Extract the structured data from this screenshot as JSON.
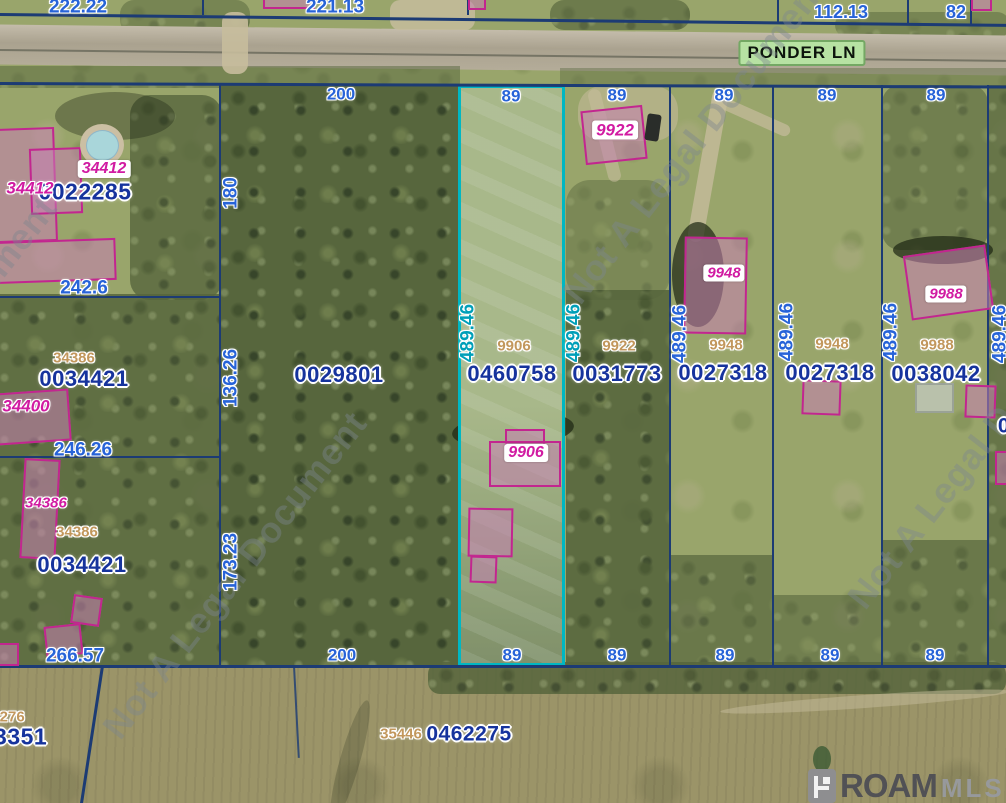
{
  "map": {
    "road_sign": "PONDER LN",
    "watermark_text": "Not A Legal Document",
    "watermarks": [
      {
        "x": 695,
        "y": 140
      },
      {
        "x": -75,
        "y": 360
      },
      {
        "x": 235,
        "y": 575
      },
      {
        "x": 980,
        "y": 445
      }
    ],
    "logo": {
      "name": "ROAM",
      "suffix": "MLS"
    },
    "highlight_color": "#00b7c3",
    "parcel_line_color": "#1c3b74",
    "subject_parcel": {
      "id": "0460758",
      "address": "9906",
      "frontage": "89",
      "depth": "489.46"
    }
  },
  "labels": [
    {
      "n": "dim-222-22",
      "t": "222.22",
      "x": 78,
      "y": 7,
      "c": "dim",
      "fs": 19
    },
    {
      "n": "dim-221-13",
      "t": "221.13",
      "x": 335,
      "y": 7,
      "c": "dim",
      "fs": 19
    },
    {
      "n": "dim-112-13",
      "t": "112.13",
      "x": 841,
      "y": 12,
      "c": "dim",
      "fs": 18
    },
    {
      "n": "dim-82",
      "t": "82",
      "x": 956,
      "y": 12,
      "c": "dim",
      "fs": 18
    },
    {
      "n": "dim-242-6",
      "t": "242.6",
      "x": 84,
      "y": 288,
      "c": "dim",
      "fs": 19
    },
    {
      "n": "dim-200-top",
      "t": "200",
      "x": 341,
      "y": 94,
      "c": "dim",
      "fs": 17
    },
    {
      "n": "dim-180",
      "t": "180",
      "x": 231,
      "y": 193,
      "c": "dim",
      "fs": 19,
      "r": -90
    },
    {
      "n": "dim-136-26",
      "t": "136.26",
      "x": 231,
      "y": 378,
      "c": "dim",
      "fs": 19,
      "r": -90
    },
    {
      "n": "dim-246-26",
      "t": "246.26",
      "x": 83,
      "y": 450,
      "c": "dim",
      "fs": 19
    },
    {
      "n": "dim-173-23",
      "t": "173.23",
      "x": 231,
      "y": 562,
      "c": "dim",
      "fs": 19,
      "r": -90
    },
    {
      "n": "dim-266-57",
      "t": "266.57",
      "x": 75,
      "y": 656,
      "c": "dim",
      "fs": 19
    },
    {
      "n": "dim-200-bottom",
      "t": "200",
      "x": 342,
      "y": 655,
      "c": "dim",
      "fs": 17
    },
    {
      "n": "dim-89-top-1",
      "t": "89",
      "x": 511,
      "y": 96,
      "c": "dim",
      "fs": 17
    },
    {
      "n": "dim-89-top-2",
      "t": "89",
      "x": 617,
      "y": 95,
      "c": "dim",
      "fs": 17
    },
    {
      "n": "dim-89-top-3",
      "t": "89",
      "x": 724,
      "y": 95,
      "c": "dim",
      "fs": 17
    },
    {
      "n": "dim-89-top-4",
      "t": "89",
      "x": 827,
      "y": 95,
      "c": "dim",
      "fs": 17
    },
    {
      "n": "dim-89-top-5",
      "t": "89",
      "x": 936,
      "y": 95,
      "c": "dim",
      "fs": 17
    },
    {
      "n": "dim-89-bot-1",
      "t": "89",
      "x": 512,
      "y": 655,
      "c": "dim",
      "fs": 17
    },
    {
      "n": "dim-89-bot-2",
      "t": "89",
      "x": 617,
      "y": 655,
      "c": "dim",
      "fs": 17
    },
    {
      "n": "dim-89-bot-3",
      "t": "89",
      "x": 725,
      "y": 655,
      "c": "dim",
      "fs": 17
    },
    {
      "n": "dim-89-bot-4",
      "t": "89",
      "x": 830,
      "y": 655,
      "c": "dim",
      "fs": 17
    },
    {
      "n": "dim-89-bot-5",
      "t": "89",
      "x": 935,
      "y": 655,
      "c": "dim",
      "fs": 17
    },
    {
      "n": "dim-489-46-1",
      "t": "489.46",
      "x": 468,
      "y": 333,
      "c": "dimTeal",
      "fs": 19,
      "r": -90
    },
    {
      "n": "dim-489-46-2",
      "t": "489.46",
      "x": 574,
      "y": 333,
      "c": "dimTeal",
      "fs": 19,
      "r": -90
    },
    {
      "n": "dim-489-46-3",
      "t": "489.46",
      "x": 680,
      "y": 334,
      "c": "dim",
      "fs": 19,
      "r": -90
    },
    {
      "n": "dim-489-46-4",
      "t": "489.46",
      "x": 787,
      "y": 332,
      "c": "dim",
      "fs": 19,
      "r": -90
    },
    {
      "n": "dim-489-46-5",
      "t": "489.46",
      "x": 891,
      "y": 332,
      "c": "dim",
      "fs": 19,
      "r": -90
    },
    {
      "n": "dim-489-46-6",
      "t": "489.46",
      "x": 1000,
      "y": 334,
      "c": "dim",
      "fs": 19,
      "r": -90
    },
    {
      "n": "pid-0022285",
      "t": "0022285",
      "x": 85,
      "y": 192,
      "c": "pid",
      "fs": 23
    },
    {
      "n": "pid-0034421-a",
      "t": "0034421",
      "x": 84,
      "y": 379,
      "c": "pid",
      "fs": 22
    },
    {
      "n": "pid-0029801",
      "t": "0029801",
      "x": 339,
      "y": 375,
      "c": "pid",
      "fs": 22
    },
    {
      "n": "pid-0460758",
      "t": "0460758",
      "x": 512,
      "y": 374,
      "c": "pid",
      "fs": 22
    },
    {
      "n": "pid-0031773",
      "t": "0031773",
      "x": 617,
      "y": 374,
      "c": "pid",
      "fs": 22
    },
    {
      "n": "pid-0027318-a",
      "t": "0027318",
      "x": 723,
      "y": 373,
      "c": "pid",
      "fs": 22
    },
    {
      "n": "pid-0027318-b",
      "t": "0027318",
      "x": 830,
      "y": 373,
      "c": "pid",
      "fs": 22
    },
    {
      "n": "pid-0038042",
      "t": "0038042",
      "x": 936,
      "y": 374,
      "c": "pid",
      "fs": 22
    },
    {
      "n": "pid-0034421-b",
      "t": "0034421",
      "x": 82,
      "y": 565,
      "c": "pid",
      "fs": 22
    },
    {
      "n": "pid-0462275",
      "t": "0462275",
      "x": 469,
      "y": 734,
      "c": "pid",
      "fs": 21
    },
    {
      "n": "pid-83351",
      "t": "83351",
      "x": 14,
      "y": 737,
      "c": "pid",
      "fs": 23
    },
    {
      "n": "pid-right-cut",
      "t": "0",
      "x": 1004,
      "y": 426,
      "c": "pid",
      "fs": 21
    },
    {
      "n": "tan-34386-a",
      "t": "34386",
      "x": 74,
      "y": 358,
      "c": "tan",
      "fs": 15
    },
    {
      "n": "tan-34386-b",
      "t": "34386",
      "x": 77,
      "y": 532,
      "c": "tan",
      "fs": 15
    },
    {
      "n": "tan-9906",
      "t": "9906",
      "x": 514,
      "y": 346,
      "c": "tan",
      "fs": 15
    },
    {
      "n": "tan-9922",
      "t": "9922",
      "x": 619,
      "y": 346,
      "c": "tan",
      "fs": 15
    },
    {
      "n": "tan-9948-a",
      "t": "9948",
      "x": 726,
      "y": 345,
      "c": "tan",
      "fs": 15
    },
    {
      "n": "tan-9948-b",
      "t": "9948",
      "x": 832,
      "y": 344,
      "c": "tan",
      "fs": 15
    },
    {
      "n": "tan-9988",
      "t": "9988",
      "x": 937,
      "y": 345,
      "c": "tan",
      "fs": 15
    },
    {
      "n": "tan-35446",
      "t": "35446",
      "x": 401,
      "y": 734,
      "c": "tan",
      "fs": 15
    },
    {
      "n": "tan-34276-cut",
      "t": "4276",
      "x": 8,
      "y": 717,
      "c": "tan",
      "fs": 15
    },
    {
      "n": "mag-34412-a",
      "t": "34412",
      "x": 104,
      "y": 169,
      "c": "magBox",
      "fs": 16
    },
    {
      "n": "mag-34412-b",
      "t": "34412",
      "x": 30,
      "y": 188,
      "c": "mag",
      "fs": 17
    },
    {
      "n": "mag-34400",
      "t": "34400",
      "x": 26,
      "y": 406,
      "c": "mag",
      "fs": 17
    },
    {
      "n": "mag-34386",
      "t": "34386",
      "x": 46,
      "y": 503,
      "c": "mag",
      "fs": 15
    },
    {
      "n": "mag-9906",
      "t": "9906",
      "x": 526,
      "y": 453,
      "c": "magBox",
      "fs": 16
    },
    {
      "n": "mag-9922",
      "t": "9922",
      "x": 615,
      "y": 130,
      "c": "magBox",
      "fs": 17
    },
    {
      "n": "mag-9948",
      "t": "9948",
      "x": 724,
      "y": 273,
      "c": "magBox",
      "fs": 15
    },
    {
      "n": "mag-9988",
      "t": "9988",
      "x": 946,
      "y": 294,
      "c": "magBox",
      "fs": 15
    }
  ]
}
